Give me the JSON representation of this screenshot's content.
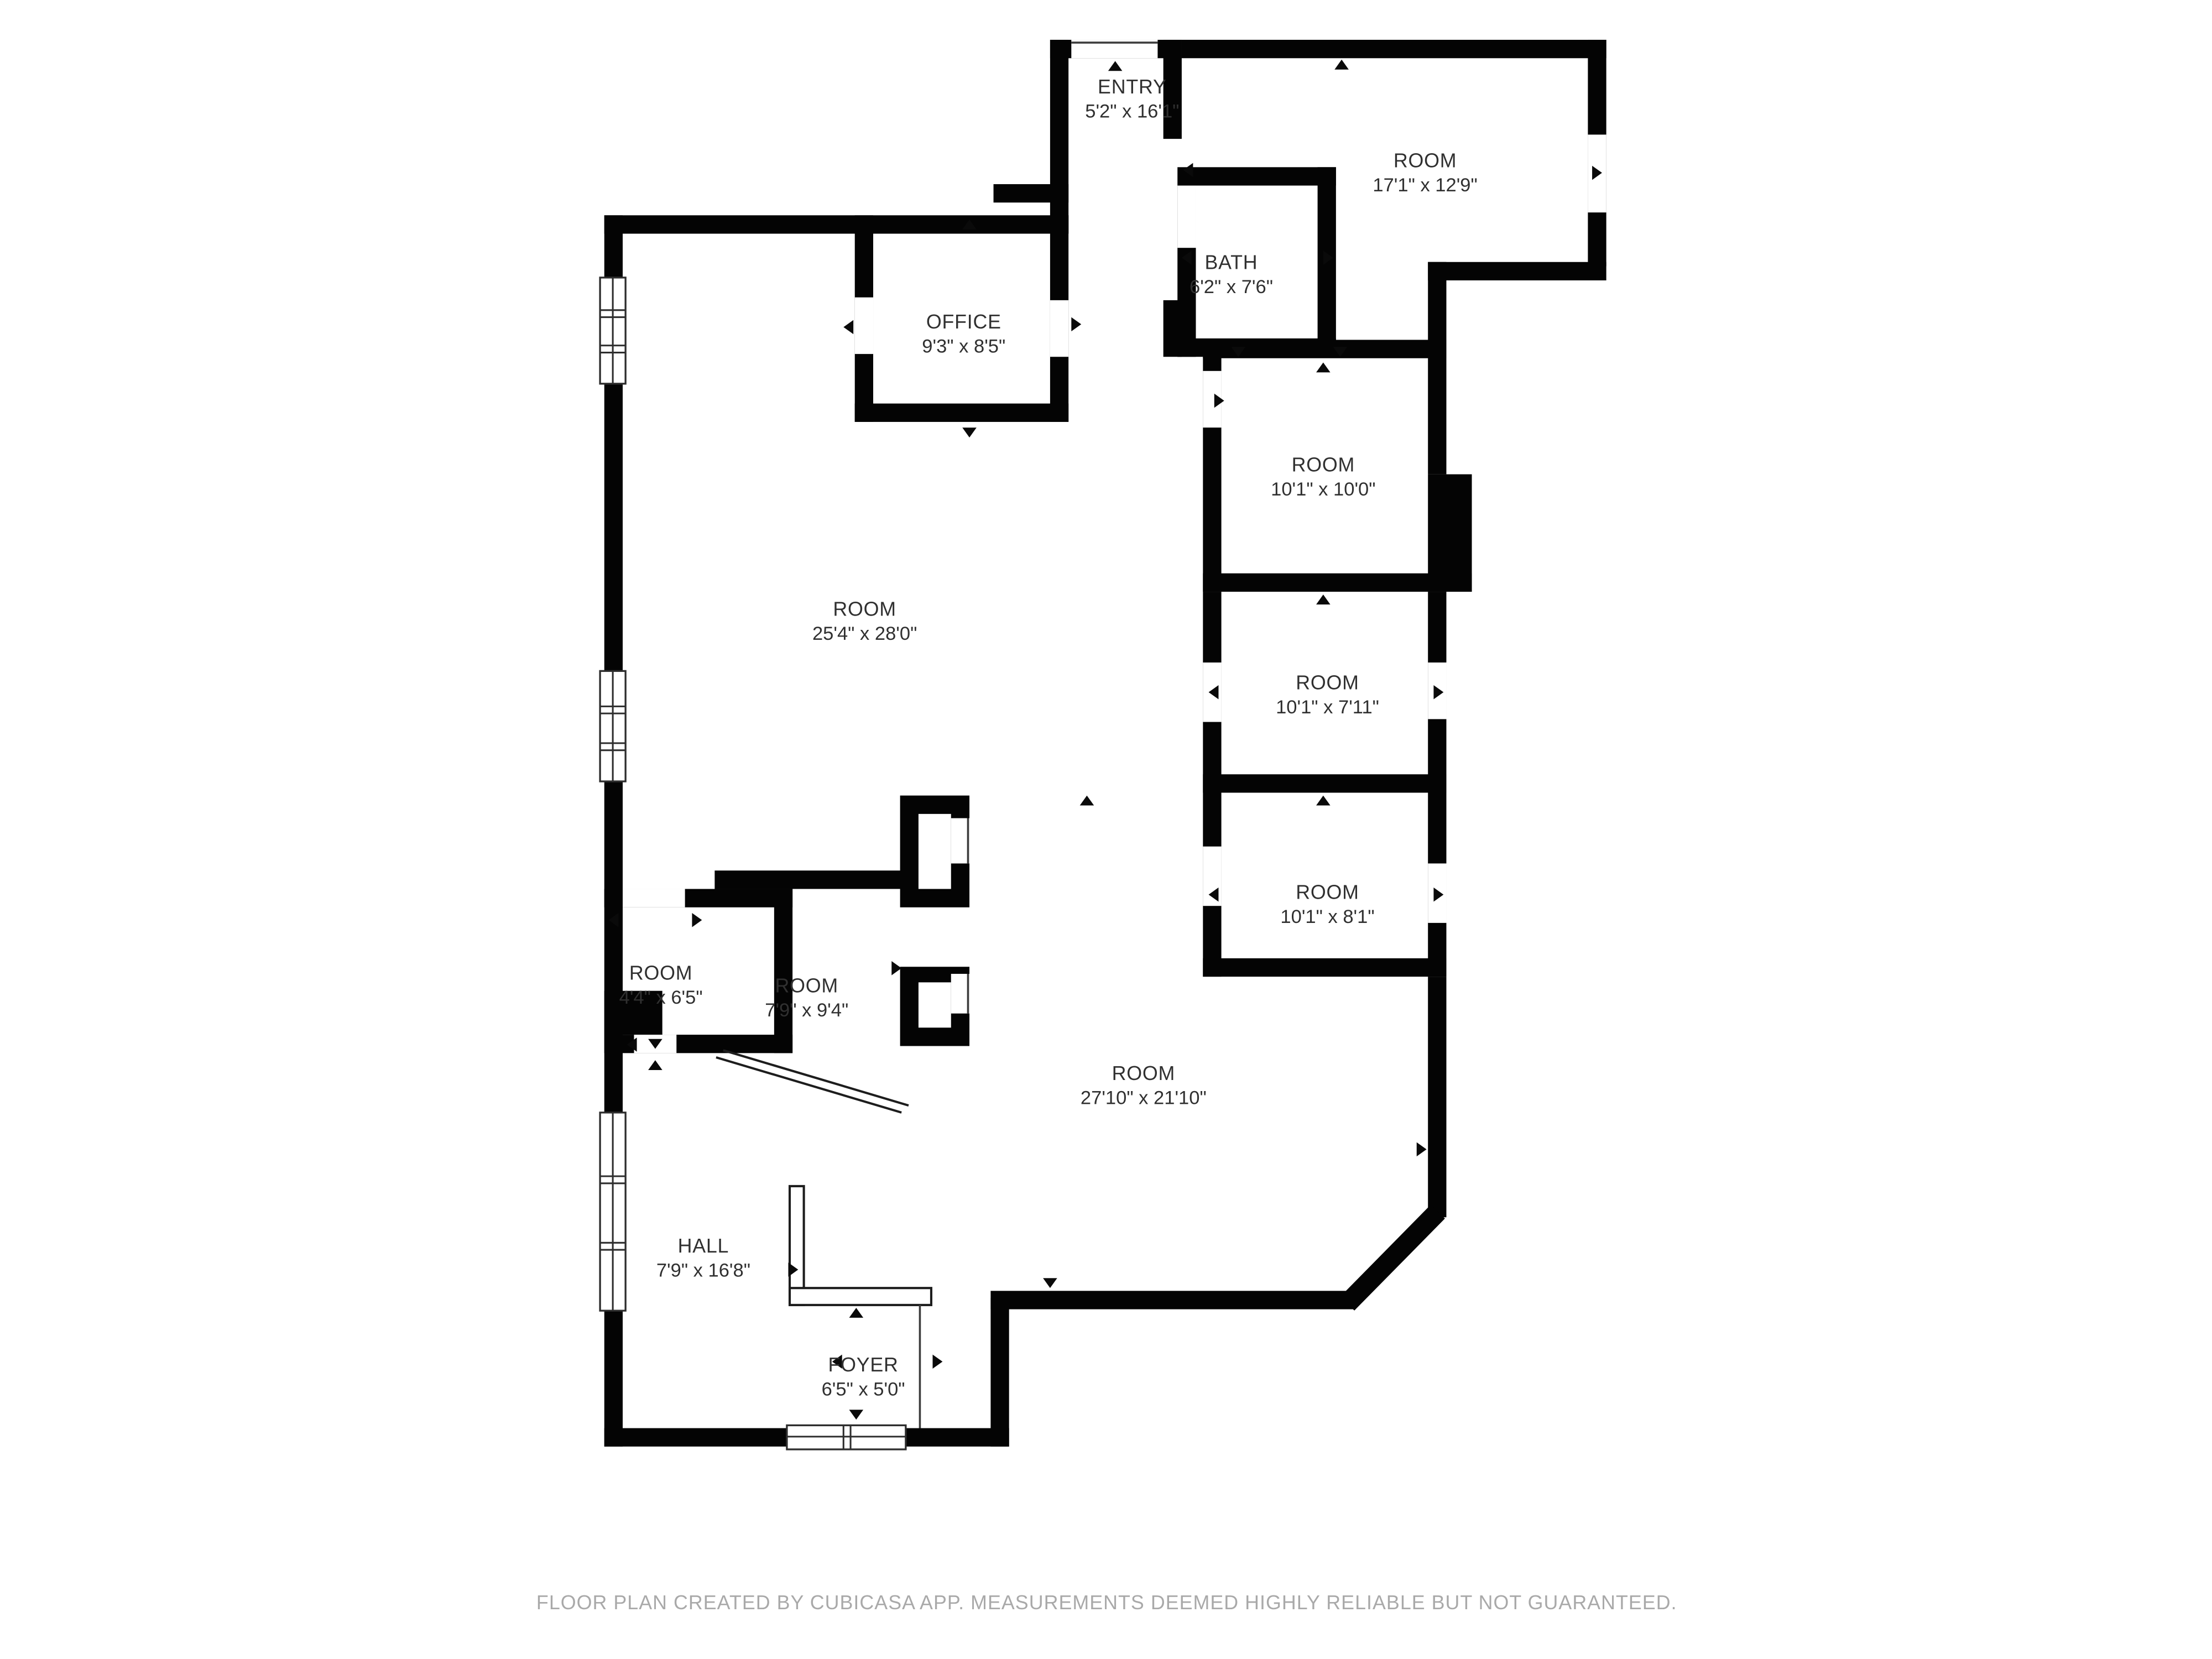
{
  "title": "Floor plan",
  "colors": {
    "wall": "#040404",
    "label": "#303030",
    "disclaimer": "#a9a9a9"
  },
  "rooms": [
    {
      "key": "entry",
      "name": "ENTRY",
      "dims": "5'2\" x 16'1\""
    },
    {
      "key": "room-17",
      "name": "ROOM",
      "dims": "17'1\" x 12'9\""
    },
    {
      "key": "bath",
      "name": "BATH",
      "dims": "6'2\" x 7'6\""
    },
    {
      "key": "office",
      "name": "OFFICE",
      "dims": "9'3\" x 8'5\""
    },
    {
      "key": "room-10",
      "name": "ROOM",
      "dims": "10'1\" x 10'0\""
    },
    {
      "key": "room-25",
      "name": "ROOM",
      "dims": "25'4\" x 28'0\""
    },
    {
      "key": "room-711",
      "name": "ROOM",
      "dims": "10'1\" x 7'11\""
    },
    {
      "key": "room-81",
      "name": "ROOM",
      "dims": "10'1\" x 8'1\""
    },
    {
      "key": "room-44",
      "name": "ROOM",
      "dims": "4'4\" x 6'5\""
    },
    {
      "key": "room-79",
      "name": "ROOM",
      "dims": "7'9\" x 9'4\""
    },
    {
      "key": "room-27",
      "name": "ROOM",
      "dims": "27'10\" x 21'10\""
    },
    {
      "key": "hall",
      "name": "HALL",
      "dims": "7'9\" x 16'8\""
    },
    {
      "key": "foyer",
      "name": "FOYER",
      "dims": "6'5\" x 5'0\""
    }
  ],
  "footer": {
    "disclaimer": "FLOOR PLAN CREATED BY CUBICASA APP. MEASUREMENTS DEEMED HIGHLY RELIABLE BUT NOT GUARANTEED."
  }
}
